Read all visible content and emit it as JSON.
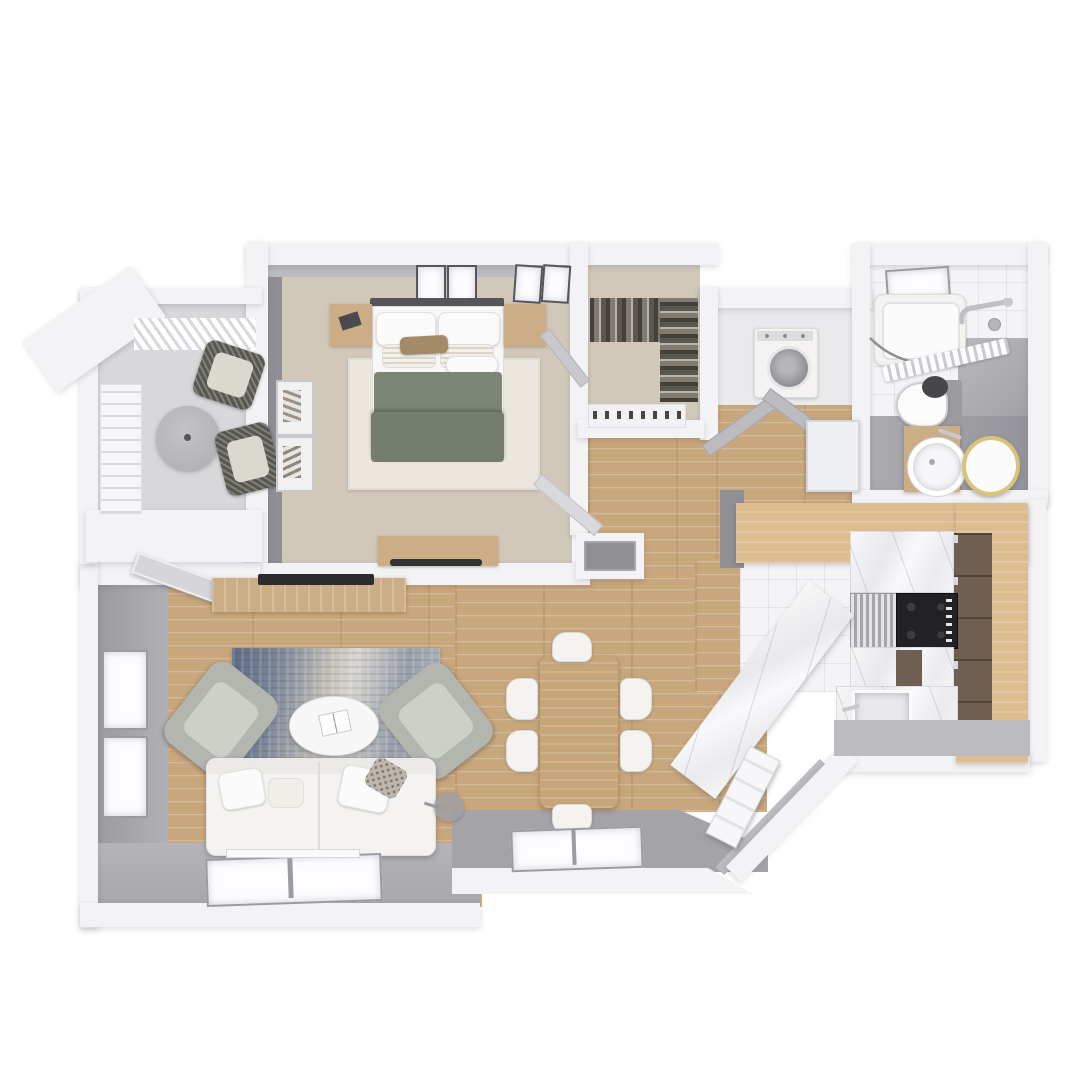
{
  "scene": {
    "title": "3D apartment floor plan render",
    "view": "top-down 3D render",
    "background": "white",
    "visible_text": "none"
  },
  "palette": {
    "bg": "#ffffff",
    "wall_white": "#f3f3f5",
    "wall_gray": "#a3a3a8",
    "wall_gray_dark": "#8f8f94",
    "wall_gray_light": "#bcbcc0",
    "balcony_floor": "#d8d7da",
    "carpet": "#d1c8ba",
    "wood_floor": "#c9a77c",
    "wood_furniture": "#cbae85",
    "breakfast_bar": "#dcbd90",
    "tile": "#f4f4f6",
    "marble": "#efeff2",
    "cabinet_dark": "#6e5f52",
    "duvet_sage": "#7d8577",
    "duvet_sage_dark": "#757d6f",
    "sofa_white": "#f4f3f1",
    "armchair_gray": "#b2b6af",
    "rug_blue": "#5c6b85",
    "rug_cream": "#d8d5cf",
    "mirror_gold": "#d9c27a",
    "appliance_black": "#222226",
    "steel": "#c9c9cd"
  },
  "rooms": [
    {
      "name": "balcony",
      "floor": "gray concrete",
      "furniture": [
        "round-table",
        "wicker-lounge-chair",
        "wicker-lounge-chair",
        "railing",
        "planter"
      ]
    },
    {
      "name": "bedroom",
      "floor": "beige carpet",
      "furniture": [
        "queen-bed-sage-duvet",
        "nightstand",
        "nightstand",
        "cream-area-rug",
        "dresser-with-tv",
        "wall-art",
        "wall-art",
        "skylight-windows"
      ]
    },
    {
      "name": "walk-in-closet",
      "floor": "beige carpet",
      "furniture": [
        "hanging-clothes-rail",
        "hanging-clothes-rail",
        "shoe-shelf"
      ]
    },
    {
      "name": "laundry-closet",
      "furniture": [
        "washer-dryer"
      ],
      "doors": [
        "bifold-doors-open"
      ]
    },
    {
      "name": "bathroom",
      "floor": "white tile",
      "furniture": [
        "bathtub",
        "shower-curtain-rod",
        "shower-curtain",
        "window",
        "grab-bar",
        "toilet",
        "wood-vanity-with-vessel-sink",
        "round-gold-mirror"
      ]
    },
    {
      "name": "hallway",
      "floor": "wood plank",
      "furniture": [
        "storage-niche-cabinet",
        "open-doors"
      ]
    },
    {
      "name": "kitchen",
      "floor": "white tile",
      "furniture": [
        "wood-breakfast-bar",
        "tall-dark-cabinets",
        "oven",
        "black-cooktop",
        "marble-counter",
        "marble-peninsula",
        "sink"
      ]
    },
    {
      "name": "dining-area",
      "floor": "wood plank",
      "furniture": [
        "wood-dining-table",
        "dining-chair",
        "dining-chair",
        "dining-chair",
        "dining-chair",
        "dining-chair",
        "dining-chair",
        "window"
      ]
    },
    {
      "name": "living-room",
      "floor": "wood plank",
      "furniture": [
        "white-sofa",
        "throw-pillows",
        "armchair",
        "armchair",
        "oval-coffee-table",
        "book",
        "abstract-blue-rug",
        "tv-console",
        "tv",
        "floor-lamp",
        "side-windows",
        "bottom-window",
        "balcony-door"
      ]
    },
    {
      "name": "entry",
      "furniture": [
        "front-door-open",
        "angled-wall"
      ]
    }
  ],
  "counts": {
    "bedrooms": 1,
    "bathrooms": 1,
    "dining_chairs": 6,
    "armchairs": 2,
    "balcony_chairs": 2,
    "windows_visible": 8
  }
}
